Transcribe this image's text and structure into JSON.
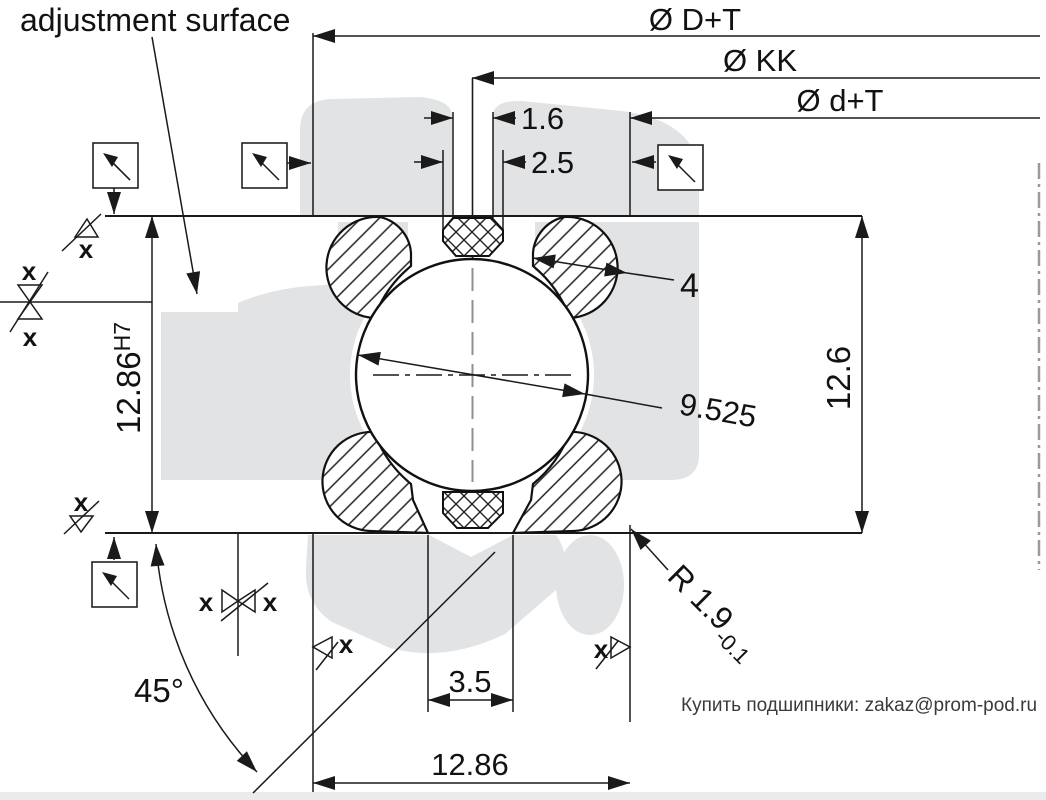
{
  "note": {
    "adjustment_surface": "adjustment surface"
  },
  "dims": {
    "outer_dia": "Ø D+T",
    "kk_dia": "Ø KK",
    "inner_dia": "Ø d+T",
    "seal_top_width": "1.6",
    "seal_mid_width": "2.5",
    "arch_offset": "4",
    "ball_dia": "9.525",
    "height_right": "12.6",
    "bore_value": "12.86",
    "bore_fit": "H7",
    "mouth_width": "3.5",
    "total_width": "12.86",
    "contact_angle": "45°",
    "radius": "R 1.9",
    "radius_tol": "-0.1"
  },
  "marks": {
    "x": "x"
  },
  "footer": {
    "contact": "Купить подшипники: zakaz@prom-pod.ru"
  },
  "colors": {
    "line": "#1a1a1a",
    "watermark": "#e2e3e5",
    "axis_dash": "#9a9a9c",
    "footer_text": "#3a3a3a"
  }
}
